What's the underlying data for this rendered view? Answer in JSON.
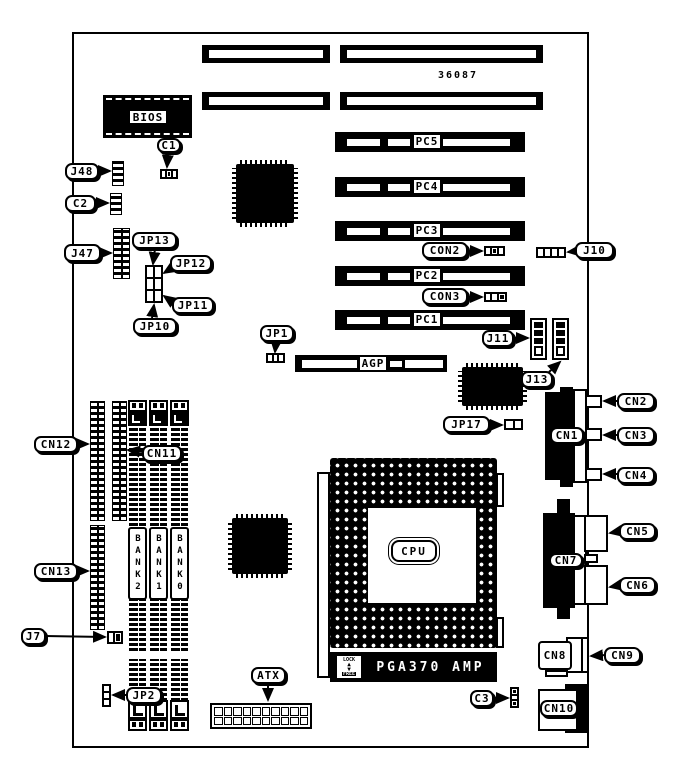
{
  "board": {
    "part_number": "36087"
  },
  "chips": {
    "bios": "BIOS",
    "cpu": "CPU",
    "socket_bottom": "PGA370 AMP",
    "lock": "LOCK",
    "free": "FREE"
  },
  "slots": {
    "pc5": "PC5",
    "pc4": "PC4",
    "pc3": "PC3",
    "pc2": "PC2",
    "pc1": "PC1",
    "agp": "AGP"
  },
  "memory": {
    "bank2": "BANK2",
    "bank1": "BANK1",
    "bank0": "BANK0"
  },
  "callouts": {
    "j48": "J48",
    "c1": "C1",
    "c2": "C2",
    "j47": "J47",
    "jp13": "JP13",
    "jp12": "JP12",
    "jp11": "JP11",
    "jp10": "JP10",
    "jp1": "JP1",
    "con2": "CON2",
    "con3": "CON3",
    "j10": "J10",
    "j11": "J11",
    "j13": "J13",
    "jp17": "JP17",
    "cn1": "CN1",
    "cn2": "CN2",
    "cn3": "CN3",
    "cn4": "CN4",
    "cn5": "CN5",
    "cn6": "CN6",
    "cn7": "CN7",
    "cn8": "CN8",
    "cn9": "CN9",
    "cn10": "CN10",
    "cn11": "CN11",
    "cn12": "CN12",
    "cn13": "CN13",
    "j7": "J7",
    "jp2": "JP2",
    "atx": "ATX",
    "c3": "C3"
  }
}
